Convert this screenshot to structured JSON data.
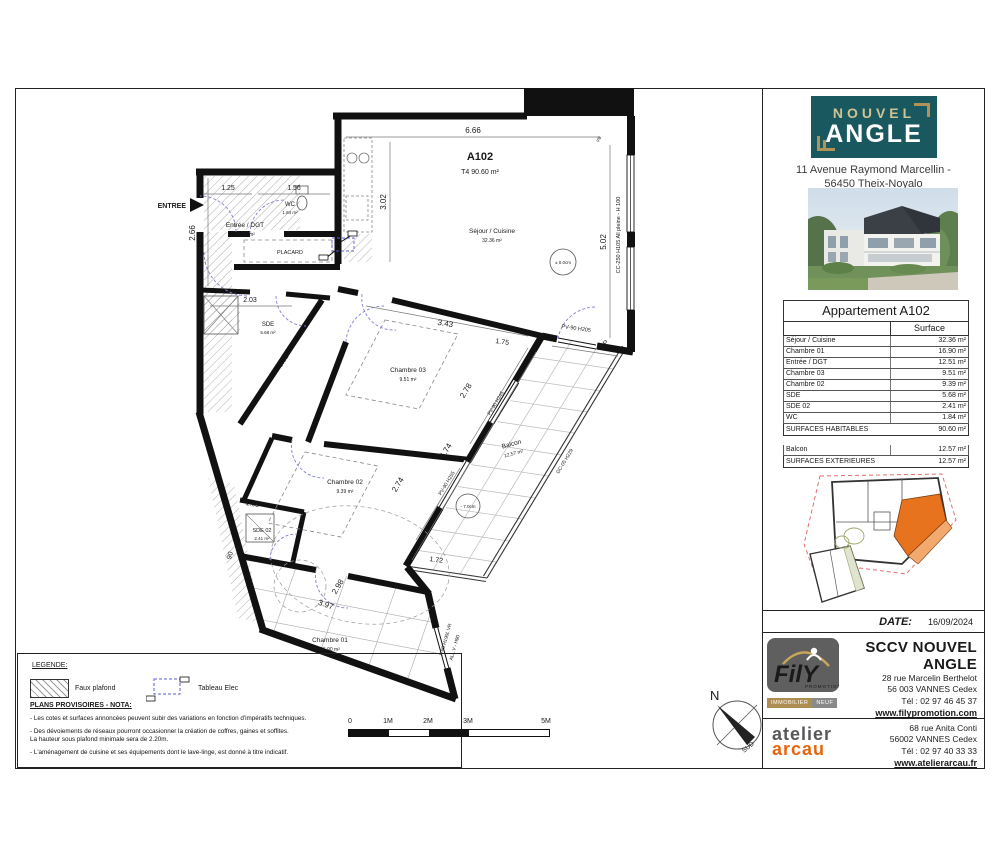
{
  "panel": {
    "brand": {
      "line1": "NOUVEL",
      "line2": "ANGLE",
      "address1": "11 Avenue Raymond Marcellin -",
      "address2": "56450 Theix-Noyalo"
    },
    "table": {
      "title": "Appartement A102",
      "col_header": "Surface",
      "rows": [
        {
          "label": "Séjour / Cuisine",
          "value": "32.36 m²"
        },
        {
          "label": "Chambre 01",
          "value": "16.90 m²"
        },
        {
          "label": "Entrée / DGT",
          "value": "12.51 m²"
        },
        {
          "label": "Chambre 03",
          "value": "9.51 m²"
        },
        {
          "label": "Chambre 02",
          "value": "9.39 m²"
        },
        {
          "label": "SDE",
          "value": "5.68 m²"
        },
        {
          "label": "SDE 02",
          "value": "2.41 m²"
        },
        {
          "label": "WC",
          "value": "1.84 m²"
        }
      ],
      "total_label": "SURFACES HABITABLES",
      "total_value": "90.60 m²",
      "ext_rows": [
        {
          "label": "Balcon",
          "value": "12.57 m²"
        }
      ],
      "ext_total_label": "SURFACES EXTERIEURES",
      "ext_total_value": "12.57 m²"
    },
    "date_label": "DATE:",
    "date_value": "16/09/2024",
    "promoter": {
      "name": "SCCV NOUVEL ANGLE",
      "addr1": "28 rue Marcelin Berthelot",
      "addr2": "56 003 VANNES Cedex",
      "tel": "Tél : 02 97 46 45 37",
      "web": "www.filypromotion.com",
      "logo_text": "FilY",
      "logo_sub": "PROMOTION",
      "logo_bar1": "IMMOBILIER",
      "logo_bar2": "NEUF"
    },
    "architect": {
      "logo_line1": "atelier",
      "logo_line2": "arcau",
      "addr1": "68 rue Anita Conti",
      "addr2": "56002 VANNES Cedex",
      "tel": "Tél : 02 97 40 33 33",
      "web": "www.atelierarcau.fr"
    }
  },
  "plan": {
    "entrance_label": "ENTREE",
    "unit_id": "A102",
    "unit_type": "T4  90.60 m²",
    "rooms": {
      "sejour": {
        "name": "Séjour / Cuisine",
        "area": "32.36 m²"
      },
      "entree": {
        "name": "Entrée / DGT",
        "area": "12.51 m²"
      },
      "wc": {
        "name": "WC",
        "area": "1.84 m²"
      },
      "placard": {
        "name": "PLACARD"
      },
      "sde": {
        "name": "SDE",
        "area": "5.68 m²"
      },
      "chambre03": {
        "name": "Chambre 03",
        "area": "9.51 m²"
      },
      "chambre02": {
        "name": "Chambre 02",
        "area": "9.39 m²"
      },
      "sde02": {
        "name": "SDE 02",
        "area": "2.41 m²"
      },
      "chambre01": {
        "name": "Chambre 01",
        "area": "16.90 m²"
      },
      "balcon": {
        "name": "Balcon",
        "area": "12.57 m²"
      }
    },
    "dims": {
      "top": "6.66",
      "kitchen": "3.02",
      "right": "5.02",
      "e1": "1.25",
      "e2": "1.56",
      "left": "2.66",
      "sde_w": "2.03",
      "sde_diag": "3.02",
      "c3_a": "3.43",
      "c3_b": "2.78",
      "c2_a": "2.74",
      "balc_len": "6.74",
      "balc_top": "1.75",
      "balc_bot": "1.72",
      "sde02_a": "1.65",
      "sde02_b": "90",
      "c1_a": "2.98",
      "c1_b": "3.97"
    },
    "labels": {
      "pv205": "PV-90 H205",
      "pv245": "PV-90 H245",
      "pv255": "PV-90 H255",
      "cc": "CC-250 H105 All pleine - H 100",
      "vb": "VB",
      "ep": "EP",
      "gc": "GC-05 H229",
      "f90": "F-90 H190L VR",
      "allv": "ALL.V - H90",
      "lvl_sejour": "± 0.0cm",
      "lvl_balcon": "- 7.0cm"
    }
  },
  "legend": {
    "title": "LEGENDE:",
    "faux_plafond": "Faux plafond",
    "tableau": "Tableau Elec",
    "nota_title": "PLANS PROVISOIRES - NOTA:",
    "notes": [
      "- Les cotes et surfaces annoncées peuvent subir des variations en fonction d'impératifs techniques.",
      "- Des dévoiements de réseaux pourront occasionner la création de coffres, gaines et soffites.\nLa hauteur sous plafond minimale sera de 2.20m.",
      "- L'aménagement de cuisine et ses équipements dont le lave-linge, est donné à titre indicatif."
    ]
  },
  "scalebar": {
    "l0": "0",
    "l1": "1M",
    "l2": "2M",
    "l3": "3M",
    "l5": "5M"
  },
  "compass": {
    "north": "N",
    "south": "SUD"
  }
}
